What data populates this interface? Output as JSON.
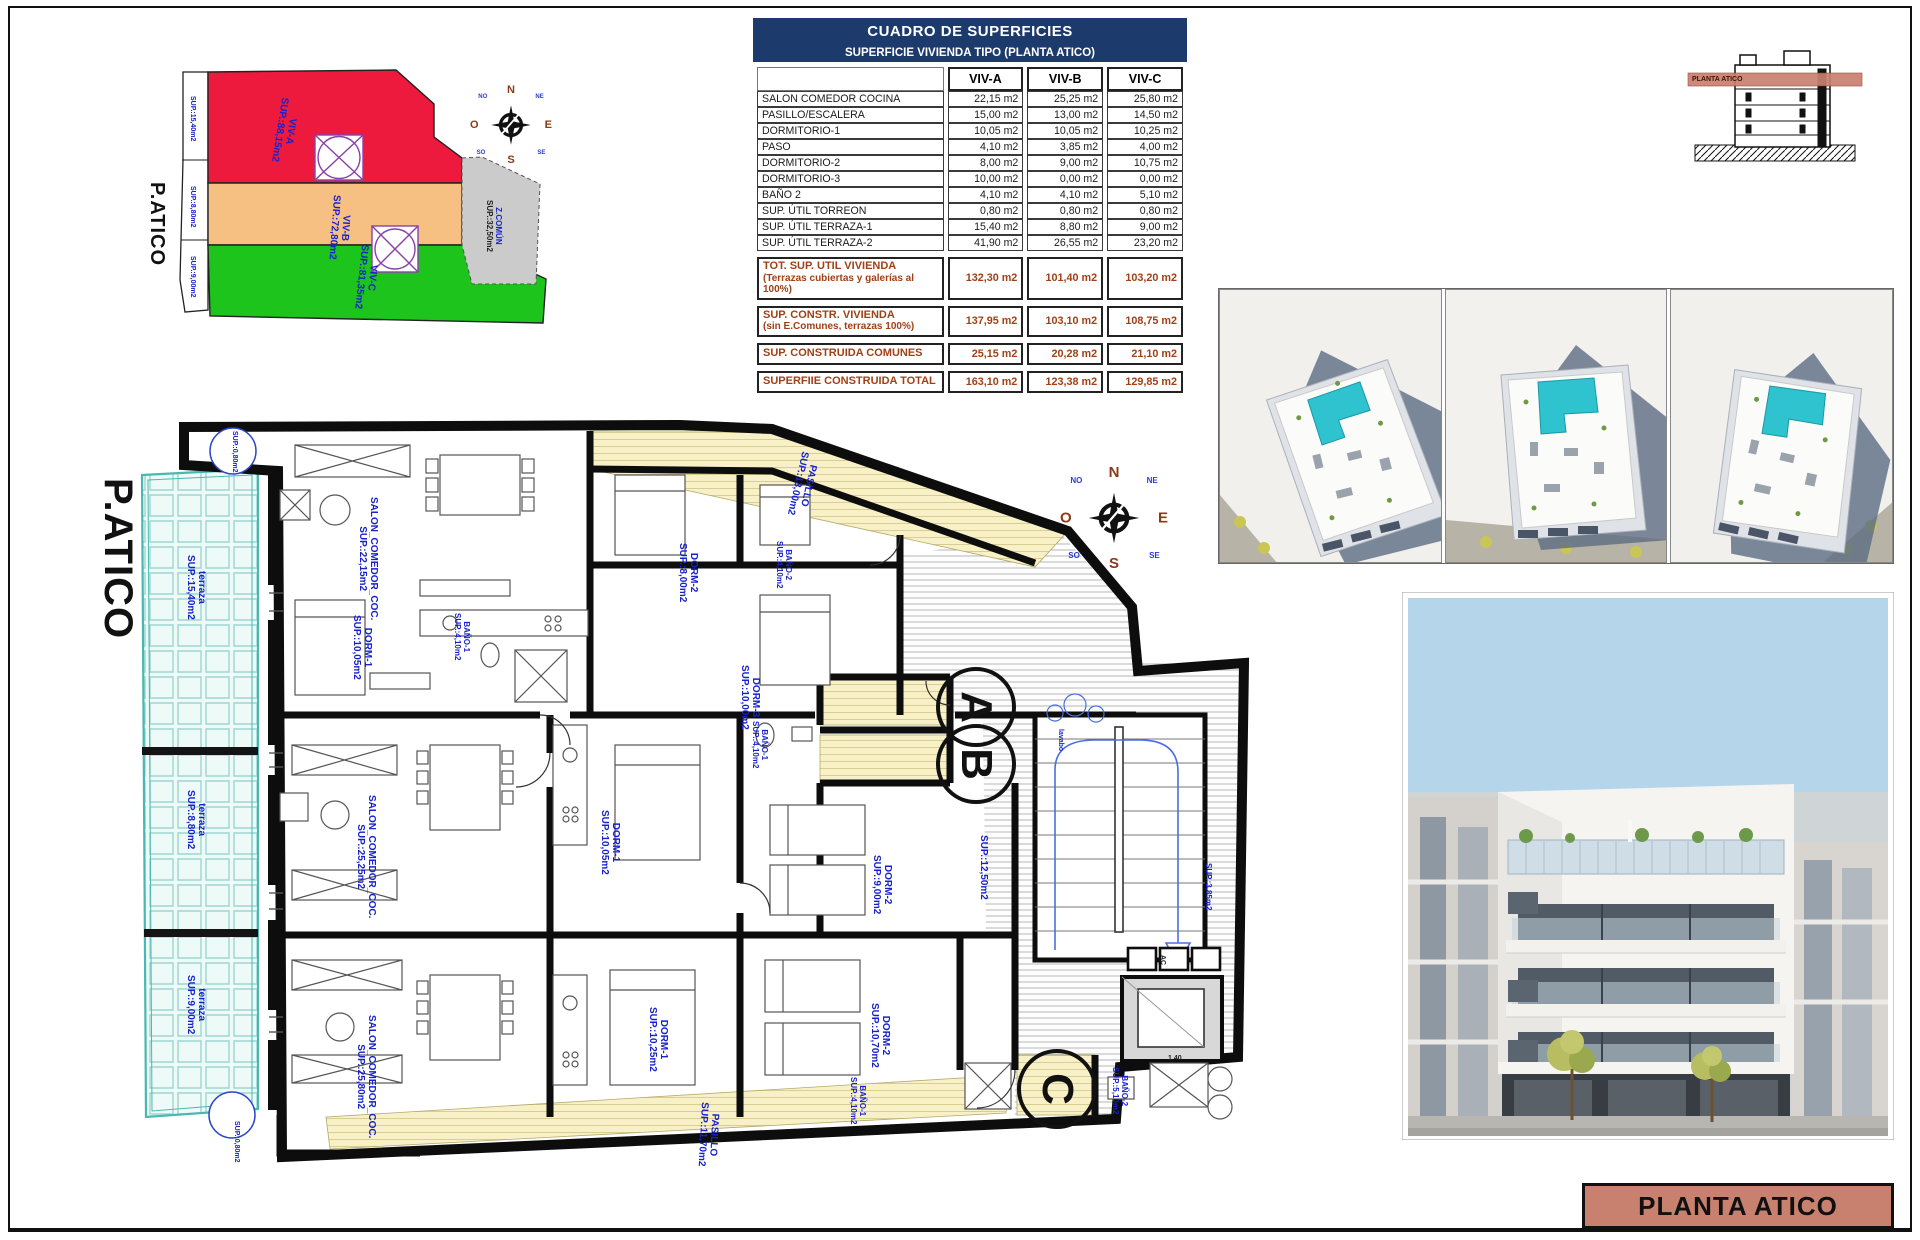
{
  "colors": {
    "table_header_navy": "#1d3a6d",
    "totals_brown": "#a04016",
    "plan_label_blue": "#1822cc",
    "title_block_salmon": "#c9816f",
    "terrace_teal": "#49b8b0",
    "pasillo_yellow": "#f8f1c8",
    "zone_red": "#ee1a3d",
    "zone_orange": "#f6c083",
    "zone_green": "#1cc41c",
    "zone_gray": "#cbcbcb"
  },
  "site_plan": {
    "title_vertical": "P.ATICO",
    "zones": [
      {
        "name": "VIV-A",
        "sup": "SUP.:88,15m2",
        "color": "#ee1a3d"
      },
      {
        "name": "VIV-B",
        "sup": "SUP.:72,80m2",
        "color": "#f6c083"
      },
      {
        "name": "VIV-C",
        "sup": "SUP.:81,35m2",
        "color": "#1cc41c"
      },
      {
        "name": "Z.COMÚN",
        "sup": "SUP.:32,50m2",
        "color": "#cbcbcb"
      }
    ],
    "terrace_labels": [
      "SUP.:15,40m2",
      "SUP.:8,80m2",
      "SUP.:9,00m2"
    ]
  },
  "surface_table": {
    "title": "CUADRO DE SUPERFICIES",
    "subtitle": "SUPERFICIE VIVIENDA TIPO  (PLANTA ATICO)",
    "columns": [
      "VIV-A",
      "VIV-B",
      "VIV-C"
    ],
    "rows": [
      [
        "SALON COMEDOR COCINA",
        "22,15 m2",
        "25,25 m2",
        "25,80 m2"
      ],
      [
        "PASILLO/ESCALERA",
        "15,00 m2",
        "13,00 m2",
        "14,50 m2"
      ],
      [
        "DORMITORIO-1",
        "10,05 m2",
        "10,05 m2",
        "10,25 m2"
      ],
      [
        "PASO",
        "4,10 m2",
        "3,85 m2",
        "4,00 m2"
      ],
      [
        "DORMITORIO-2",
        "8,00 m2",
        "9,00 m2",
        "10,75 m2"
      ],
      [
        "DORMITORIO-3",
        "10,00 m2",
        "0,00 m2",
        "0,00 m2"
      ],
      [
        "BAÑO 2",
        "4,10 m2",
        "4,10 m2",
        "5,10 m2"
      ],
      [
        "SUP. ÚTIL TORREON",
        "0,80 m2",
        "0,80 m2",
        "0,80 m2"
      ],
      [
        "SUP. ÚTIL TERRAZA-1",
        "15,40 m2",
        "8,80 m2",
        "9,00 m2"
      ],
      [
        "SUP. ÚTIL TERRAZA-2",
        "41,90 m2",
        "26,55 m2",
        "23,20 m2"
      ]
    ],
    "totals": [
      {
        "label": "TOT. SUP. UTIL VIVIENDA",
        "note": "(Terrazas cubiertas y galerías al 100%)",
        "values": [
          "132,30 m2",
          "101,40 m2",
          "103,20 m2"
        ]
      },
      {
        "label": "SUP. CONSTR. VIVIENDA",
        "note": "(sin E.Comunes, terrazas 100%)",
        "values": [
          "137,95 m2",
          "103,10 m2",
          "108,75 m2"
        ]
      },
      {
        "label": "SUP. CONSTRUIDA COMUNES",
        "note": "",
        "values": [
          "25,15 m2",
          "20,28 m2",
          "21,10 m2"
        ]
      },
      {
        "label": "SUPERFIIE CONSTRUIDA TOTAL",
        "note": "",
        "values": [
          "163,10 m2",
          "123,38 m2",
          "129,85 m2"
        ]
      }
    ]
  },
  "compass": {
    "n": "N",
    "ne": "NE",
    "e": "E",
    "se": "SE",
    "s": "S",
    "sw": "SO",
    "w": "O",
    "nw": "NO"
  },
  "floor_plan": {
    "title_vertical": "P.ATICO",
    "unit_markers": {
      "a": "A",
      "b": "B",
      "c": "C"
    },
    "labels": {
      "torreon_top": {
        "sup": "SUP.:0,80m2"
      },
      "terraza_a": {
        "name": "terraza",
        "sup": "SUP.:15,40m2"
      },
      "terraza_b": {
        "name": "terraza",
        "sup": "SUP.:8,80m2"
      },
      "terraza_c": {
        "name": "terraza",
        "sup": "SUP.:9,00m2"
      },
      "torreon_bottom": {
        "sup": "SUP.:0,80m2"
      },
      "pasillo_top": {
        "name": "PASILLO",
        "sup": "SUP.:13,00m2"
      },
      "salon_a": {
        "name": "SALON_COMEDOR_COC.",
        "sup": "SUP.:22,15m2"
      },
      "dorm1_a": {
        "name": "DORM-1",
        "sup": "SUP.:10,05m2"
      },
      "bano1_a": {
        "name": "BAÑO-1",
        "sup": "SUP.:4,10m2"
      },
      "dorm2_a": {
        "name": "DORM-2",
        "sup": "SUP.:8,00m2"
      },
      "bano2_a": {
        "name": "BAÑO-2",
        "sup": "SUP.:4,10m2"
      },
      "dorm3_a": {
        "name": "DORM-3",
        "sup": "SUP.:10,00m2"
      },
      "salon_b": {
        "name": "SALON_COMEDOR_COC.",
        "sup": "SUP.:25,25m2"
      },
      "bano1_b": {
        "name": "BAÑO-1",
        "sup": "SUP.:4,10m2"
      },
      "dorm1_b": {
        "name": "DORM-1",
        "sup": "SUP.:10,05m2"
      },
      "dorm2_b": {
        "name": "DORM-2",
        "sup": "SUP.:9,00m2"
      },
      "hall": {
        "sup": "SUP.:12,50m2"
      },
      "paso": {
        "sup": "SUP.:3,85m2"
      },
      "lavabo": {
        "name": "lavabo"
      },
      "ac": {
        "name": "AC"
      },
      "salon_c": {
        "name": "SALON_COMEDOR_COC.",
        "sup": "SUP.:25,80m2"
      },
      "dorm1_c": {
        "name": "DORM-1",
        "sup": "SUP.:10,25m2"
      },
      "dorm2_c": {
        "name": "DORM-2",
        "sup": "SUP.:10,70m2"
      },
      "bano1_c": {
        "name": "BAÑO-1",
        "sup": "SUP.:4,10m2"
      },
      "bano2_c": {
        "name": "BAÑO-2",
        "sup": "SUP.:5,10m2"
      },
      "pasillo_bottom": {
        "name": "PASILLO",
        "sup": "SUP.:11,70m2"
      },
      "dim_shower": {
        "name": "1,40"
      }
    }
  },
  "section_thumb": {
    "band_label": "PLANTA ATICO"
  },
  "title_block": {
    "label": "PLANTA ATICO"
  }
}
